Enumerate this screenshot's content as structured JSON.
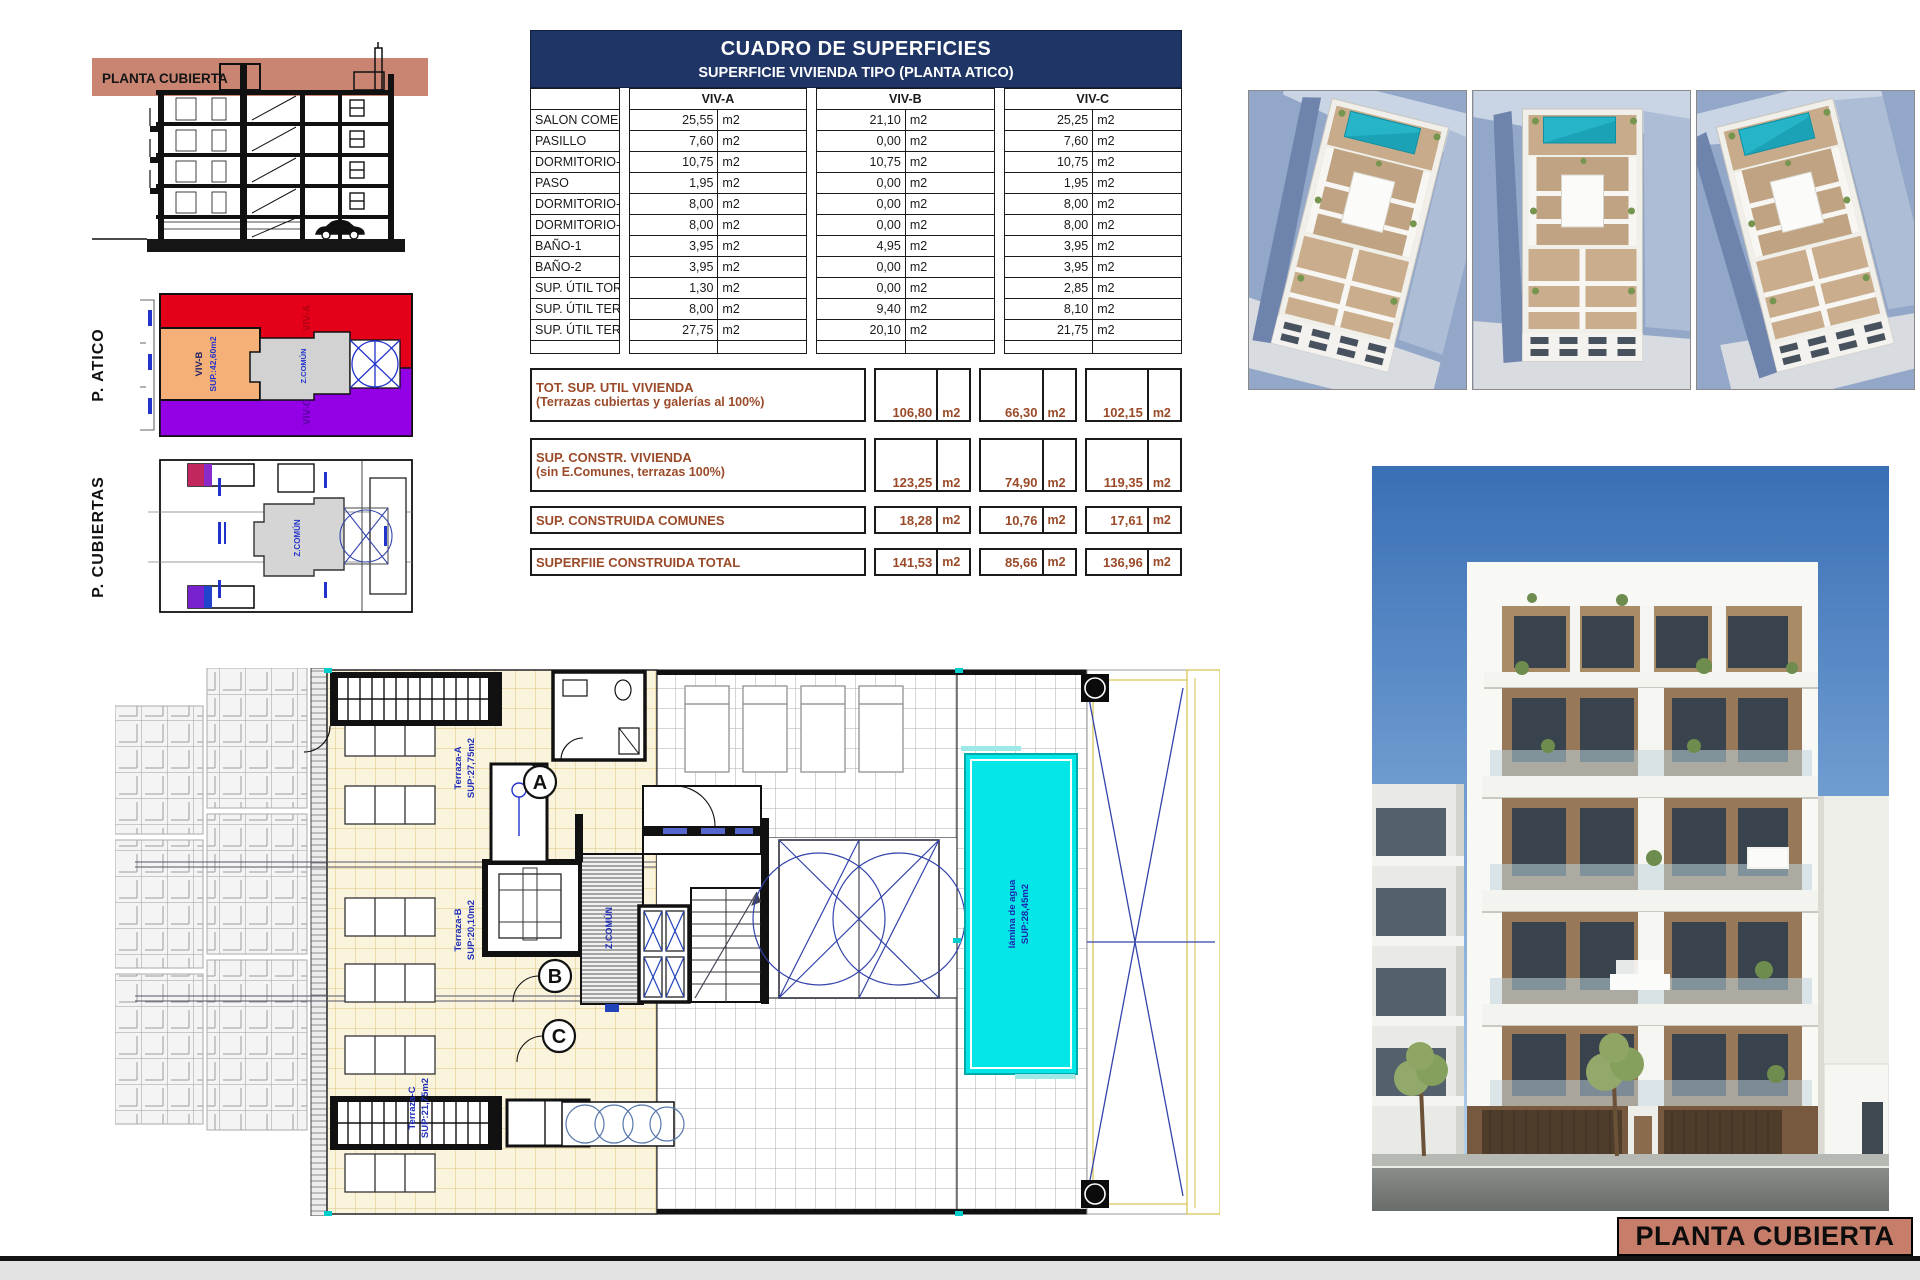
{
  "sheet": {
    "footer_label": "PLANTA CUBIERTA"
  },
  "section": {
    "band_label": "PLANTA CUBIERTA"
  },
  "side_plans": {
    "atico_label": "P. ATICO",
    "cubiertas_label": "P. CUBIERTAS",
    "viv_a": "VIV-A",
    "viv_b": "VIV-B",
    "viv_b_sup": "SUP.:42,60m2",
    "viv_c": "VIV-C",
    "zona_comun": "Z.COMÚN"
  },
  "table": {
    "title": "CUADRO DE SUPERFICIES",
    "subtitle": "SUPERFICIE VIVIENDA TIPO  (PLANTA ATICO)",
    "col_a": "VIV-A",
    "col_b": "VIV-B",
    "col_c": "VIV-C",
    "rows": [
      {
        "label": "SALON COMEDOR COCINA",
        "a": "25,55",
        "b": "21,10",
        "c": "25,25",
        "unit": "m2"
      },
      {
        "label": "PASILLO",
        "a": "7,60",
        "b": "0,00",
        "c": "7,60",
        "unit": "m2"
      },
      {
        "label": "DORMITORIO-1",
        "a": "10,75",
        "b": "10,75",
        "c": "10,75",
        "unit": "m2"
      },
      {
        "label": "PASO",
        "a": "1,95",
        "b": "0,00",
        "c": "1,95",
        "unit": "m2"
      },
      {
        "label": "DORMITORIO-2",
        "a": "8,00",
        "b": "0,00",
        "c": "8,00",
        "unit": "m2"
      },
      {
        "label": "DORMITORIO-3",
        "a": "8,00",
        "b": "0,00",
        "c": "8,00",
        "unit": "m2"
      },
      {
        "label": "BAÑO-1",
        "a": "3,95",
        "b": "4,95",
        "c": "3,95",
        "unit": "m2"
      },
      {
        "label": "BAÑO-2",
        "a": "3,95",
        "b": "0,00",
        "c": "3,95",
        "unit": "m2"
      },
      {
        "label": "SUP. ÚTIL TORREON",
        "a": "1,30",
        "b": "0,00",
        "c": "2,85",
        "unit": "m2"
      },
      {
        "label": "SUP. ÚTIL TERRAZA-1",
        "a": "8,00",
        "b": "9,40",
        "c": "8,10",
        "unit": "m2"
      },
      {
        "label": "SUP. ÚTIL TERRAZA-2 (cubierta)",
        "a": "27,75",
        "b": "20,10",
        "c": "21,75",
        "unit": "m2"
      }
    ],
    "totals": [
      {
        "label1": "TOT. SUP. UTIL VIVIENDA",
        "label2": "(Terrazas cubiertas y galerías al 100%)",
        "a": "106,80",
        "b": "66,30",
        "c": "102,15",
        "unit": "m2"
      },
      {
        "label1": "SUP. CONSTR. VIVIENDA",
        "label2": "(sin E.Comunes, terrazas 100%)",
        "a": "123,25",
        "b": "74,90",
        "c": "119,35",
        "unit": "m2"
      },
      {
        "label1": "SUP. CONSTRUIDA COMUNES",
        "label2": "",
        "a": "18,28",
        "b": "10,76",
        "c": "17,61",
        "unit": "m2"
      },
      {
        "label1": "SUPERFIIE CONSTRUIDA TOTAL",
        "label2": "",
        "a": "141,53",
        "b": "85,66",
        "c": "136,96",
        "unit": "m2"
      }
    ]
  },
  "plan": {
    "terraza_a": "Terraza-A",
    "terraza_a_sup": "SUP:27,75m2",
    "terraza_b": "Terraza-B",
    "terraza_b_sup": "SUP:20,10m2",
    "terraza_c": "Terraza-C",
    "terraza_c_sup": "SUP:21,75m2",
    "pool_line1": "lámina de agua",
    "pool_line2": "SUP:28,45m2",
    "zona_comun": "Z.COMÚN",
    "badge_a": "A",
    "badge_b": "B",
    "badge_c": "C"
  },
  "colors": {
    "navy": "#1E3565",
    "salmon": "#C67E6A",
    "brown_text": "#9A4A28",
    "pool_cyan": "#05E6E6",
    "atico_red": "#E50019",
    "atico_orange": "#F4B077",
    "atico_purple": "#9400E6",
    "tile_yellow": "#FBF4DC",
    "blue_note": "#2030B8"
  }
}
